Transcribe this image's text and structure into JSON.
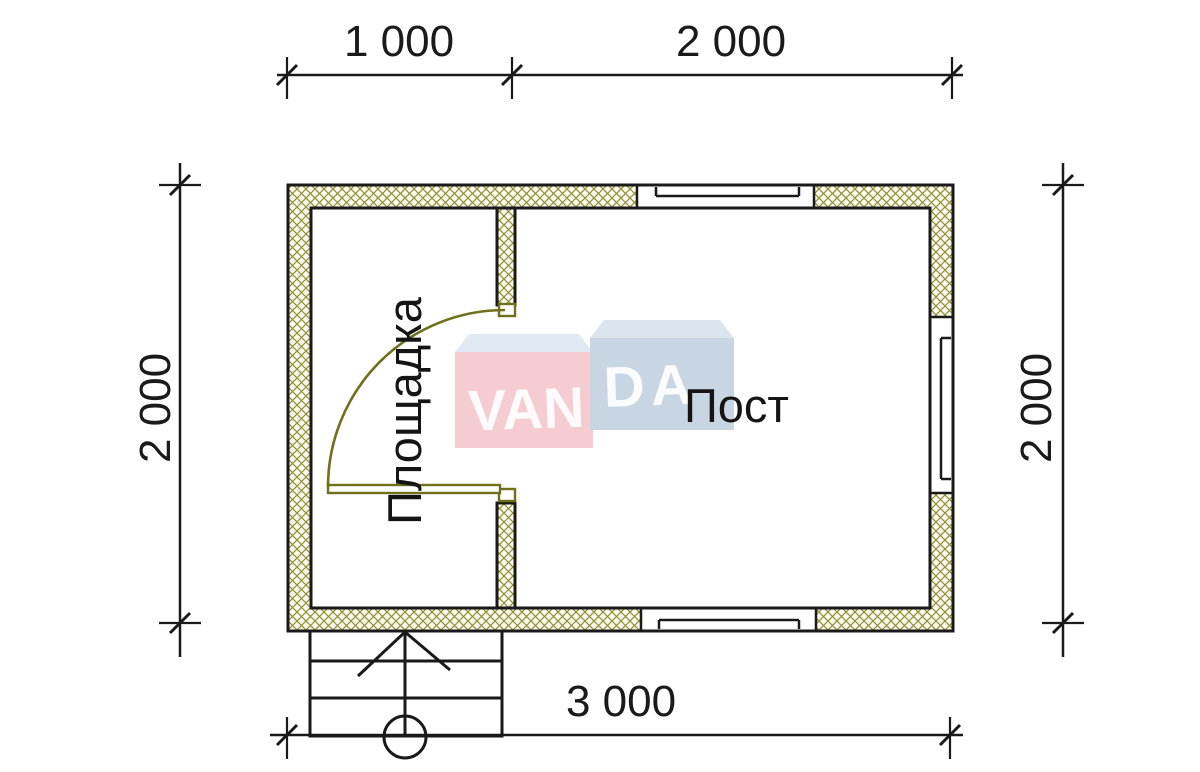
{
  "drawing": {
    "type": "floor-plan",
    "dimensions": {
      "top_segment_1": "1 000",
      "top_segment_2": "2 000",
      "left_side": "2 000",
      "right_side": "2 000",
      "bottom_total": "3 000"
    },
    "rooms": {
      "vestibule_label": "Площадка",
      "post_label": "Пост"
    },
    "features": [
      "hatched-walls",
      "door-swing",
      "three-windows",
      "stairs-with-direction-arrow"
    ]
  },
  "watermark": {
    "brand_left": "VAN",
    "brand_right": "DA",
    "full_brand": "VANDA"
  },
  "colors": {
    "line": "#1a1a1a",
    "hatch": "#8e8e3c",
    "wall_fill": "#fdfbec",
    "door": "#6f6f1d",
    "logo_pink": "#f5ccd1",
    "logo_pink_top": "#e1eaf2",
    "logo_blue": "#c8d5e3",
    "logo_blue_top": "#dbe5ee",
    "background": "#ffffff"
  }
}
